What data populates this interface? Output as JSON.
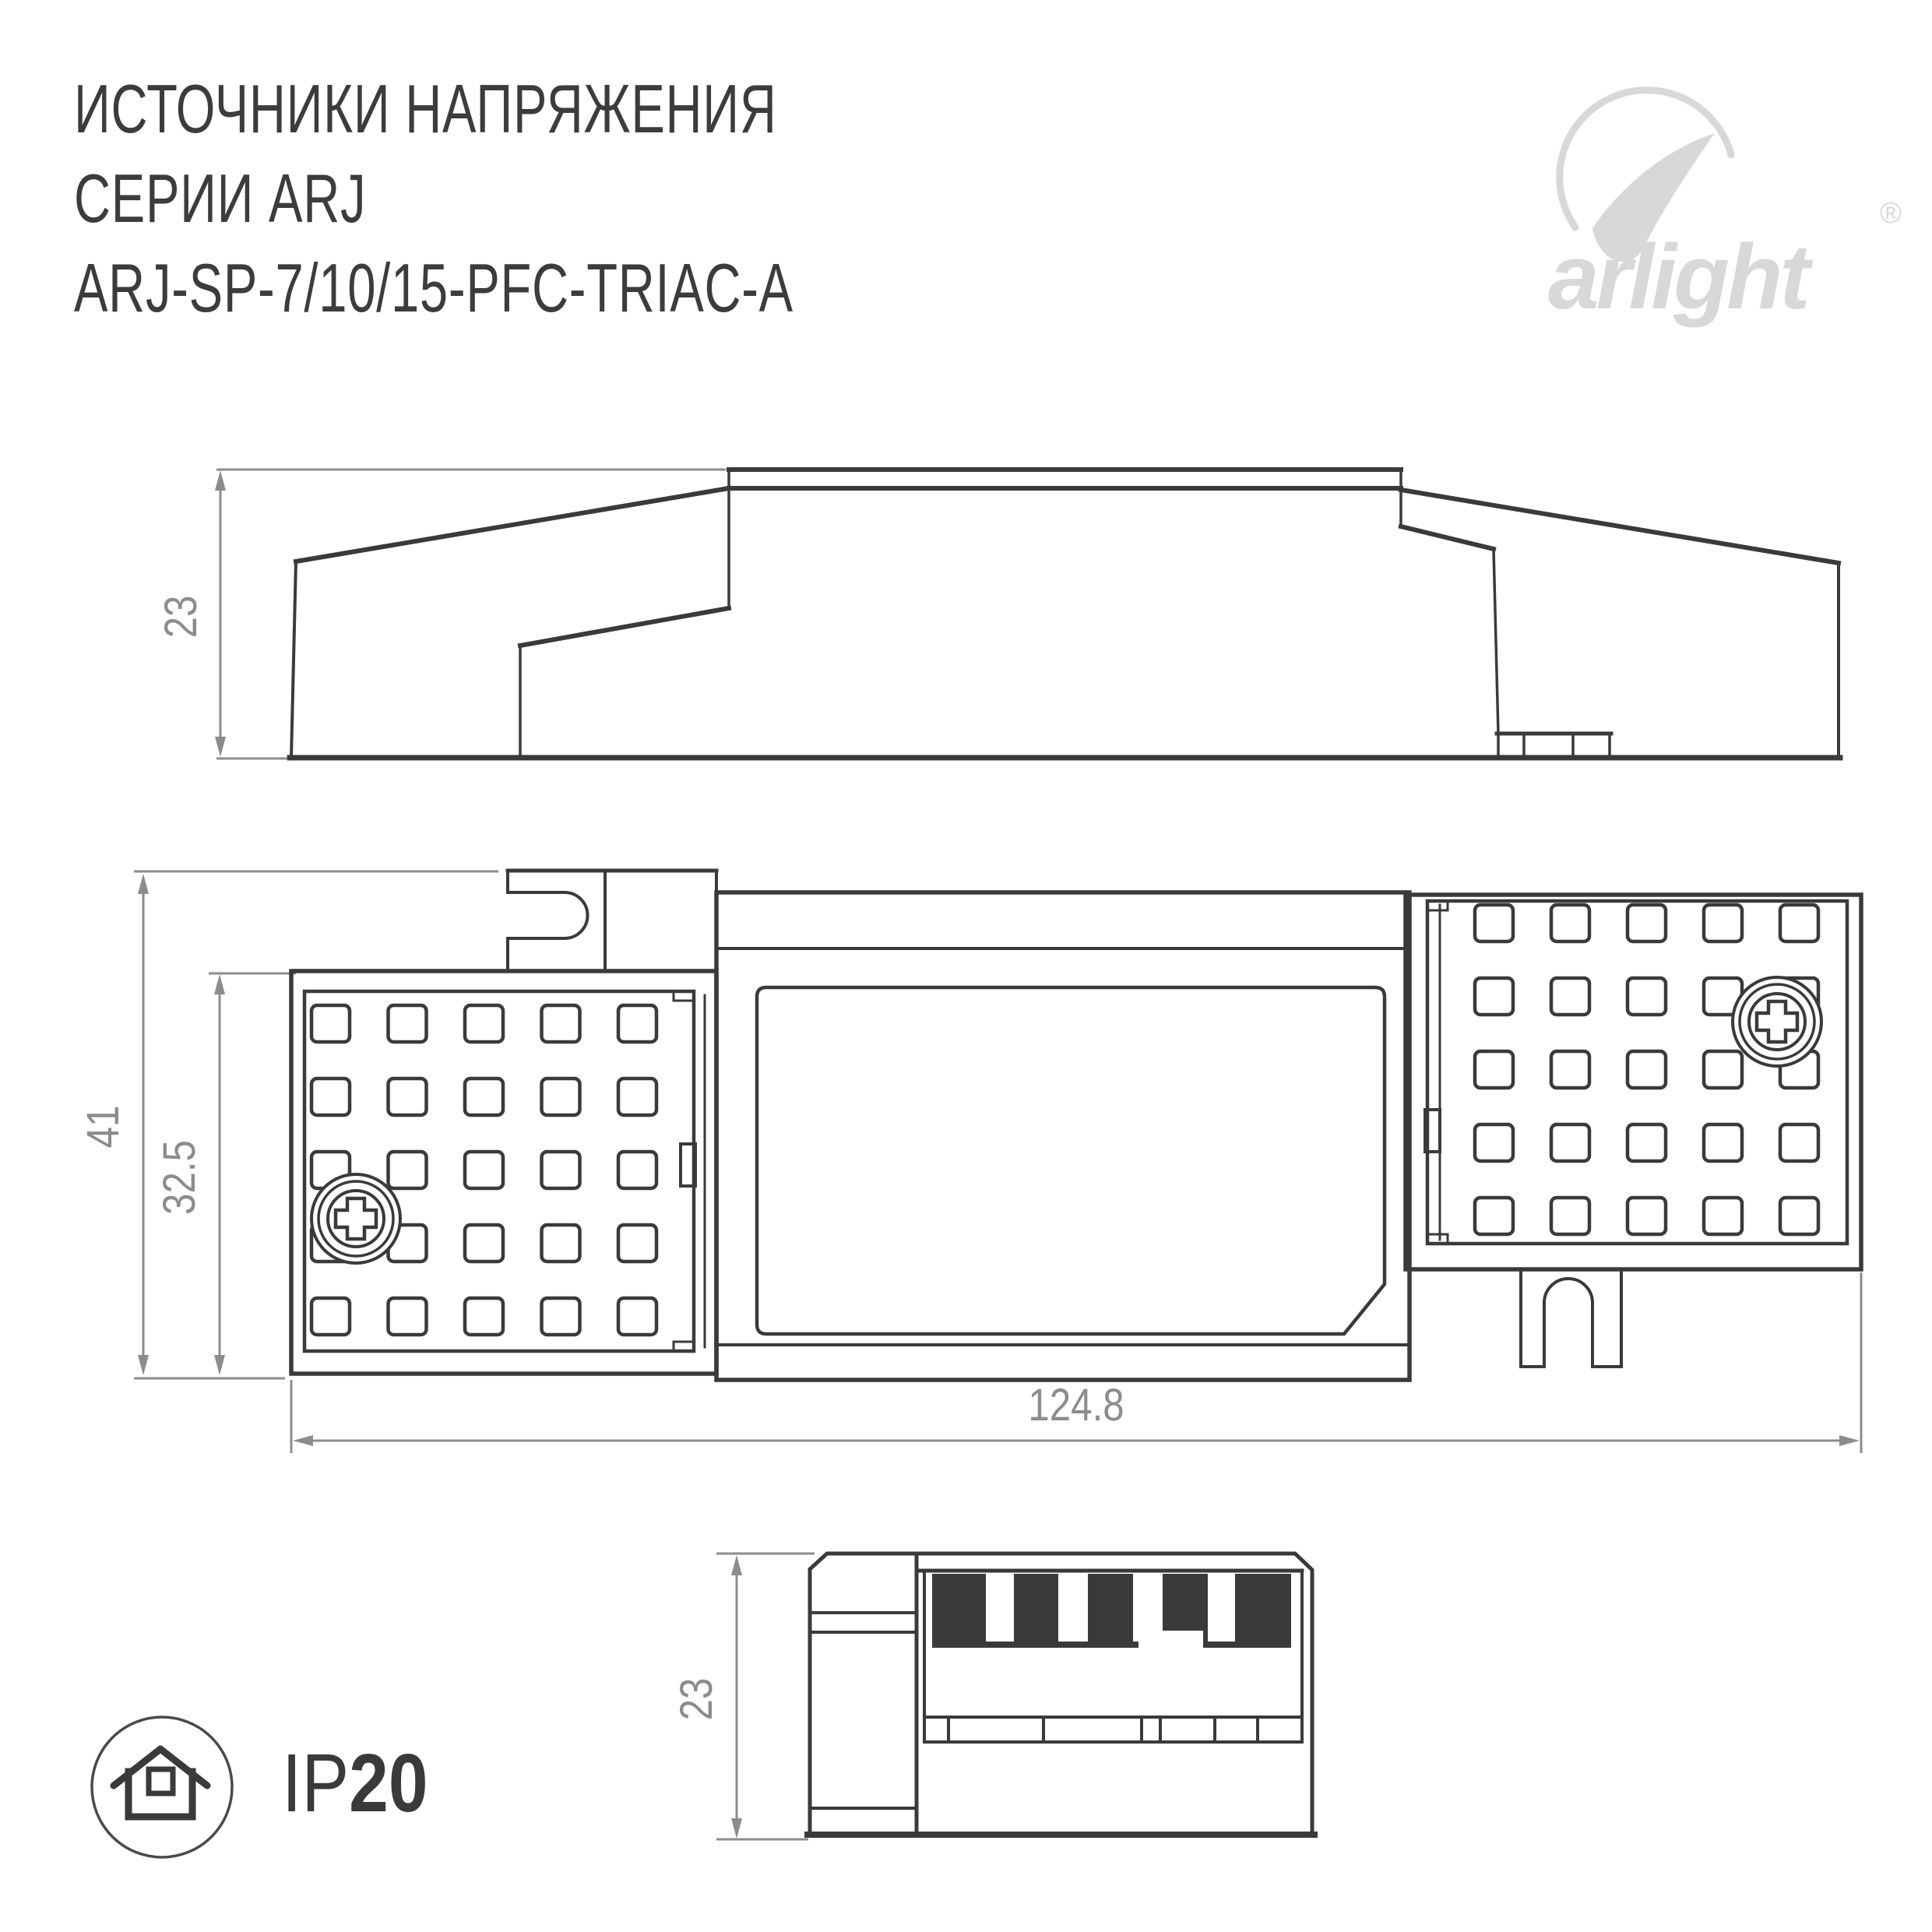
{
  "title": {
    "line1": "ИСТОЧНИКИ НАПРЯЖЕНИЯ",
    "line2": "СЕРИИ ARJ",
    "line3": "ARJ-SP-7/10/15-PFC-TRIAC-A"
  },
  "brand": {
    "wordmark": "arlight",
    "registered": "®",
    "icon": "arlight-swoosh-icon",
    "color": "#d8d8d8"
  },
  "dimensions": {
    "side_height": "23",
    "top_total_height": "41",
    "top_body_height": "32.5",
    "top_total_width": "124.8",
    "end_height": "23"
  },
  "badge": {
    "label": "IP",
    "value": "20",
    "icon": "house-in-circle-icon"
  },
  "colors": {
    "line": "#3a3a3a",
    "dimension": "#8c8c8c",
    "title": "#3c3c3c",
    "logo": "#d8d8d8",
    "background": "#ffffff"
  }
}
